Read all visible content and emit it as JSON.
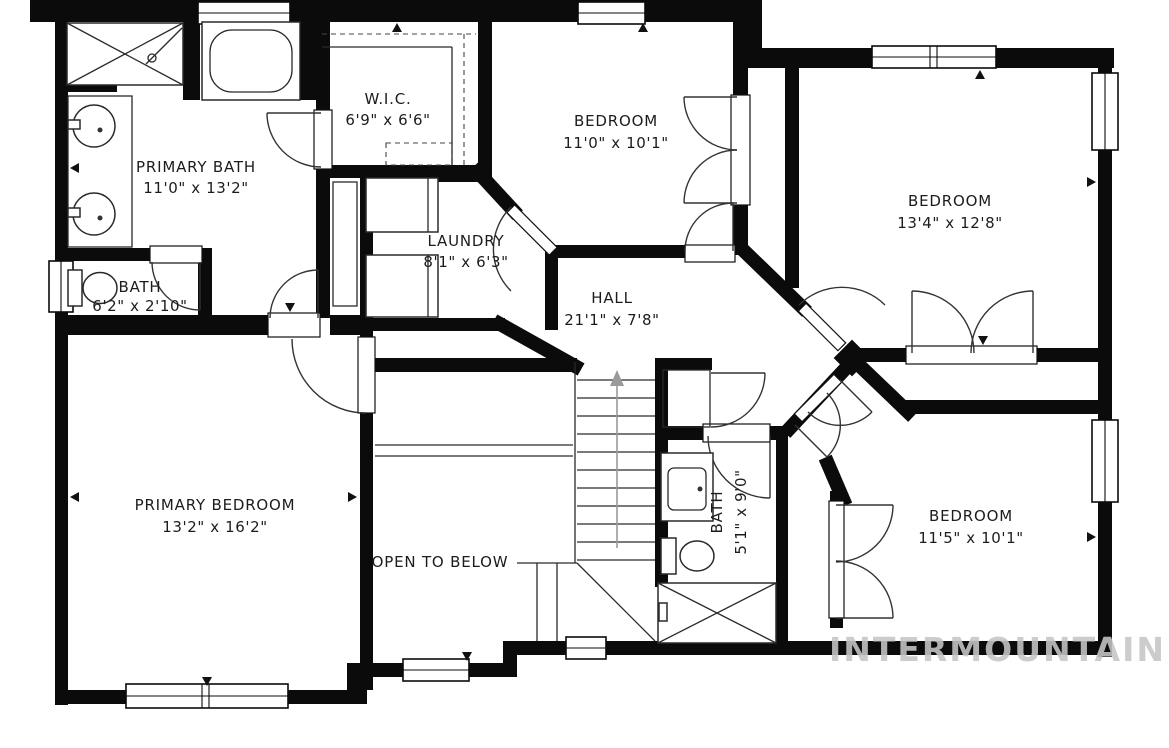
{
  "rooms": {
    "primary_bath": {
      "name": "PRIMARY BATH",
      "dims": "11'0\" x 13'2\""
    },
    "wic": {
      "name": "W.I.C.",
      "dims": "6'9\" x 6'6\""
    },
    "bedroom_top": {
      "name": "BEDROOM",
      "dims": "11'0\" x 10'1\""
    },
    "bedroom_right": {
      "name": "BEDROOM",
      "dims": "13'4\" x 12'8\""
    },
    "bath_left": {
      "name": "BATH",
      "dims": "6'2\" x 2'10\""
    },
    "laundry": {
      "name": "LAUNDRY",
      "dims": "8'1\" x 6'3\""
    },
    "hall": {
      "name": "HALL",
      "dims": "21'1\" x 7'8\""
    },
    "primary_bedroom": {
      "name": "PRIMARY BEDROOM",
      "dims": "13'2\" x 16'2\""
    },
    "open_to_below": {
      "name": "OPEN TO BELOW"
    },
    "bath_middle": {
      "name": "BATH",
      "dims": "5'1\" x 9'0\""
    },
    "bedroom_bottom": {
      "name": "BEDROOM",
      "dims": "11'5\" x 10'1\""
    }
  },
  "watermark": {
    "text": "INTERMOUNTAIN",
    "color": "#c6c6c6"
  },
  "colors": {
    "wall": "#0b0b0b",
    "line": "#2a2a2a",
    "text": "#1c1c1c",
    "stair_arrow": "#9a9a9a",
    "background": "#ffffff"
  }
}
